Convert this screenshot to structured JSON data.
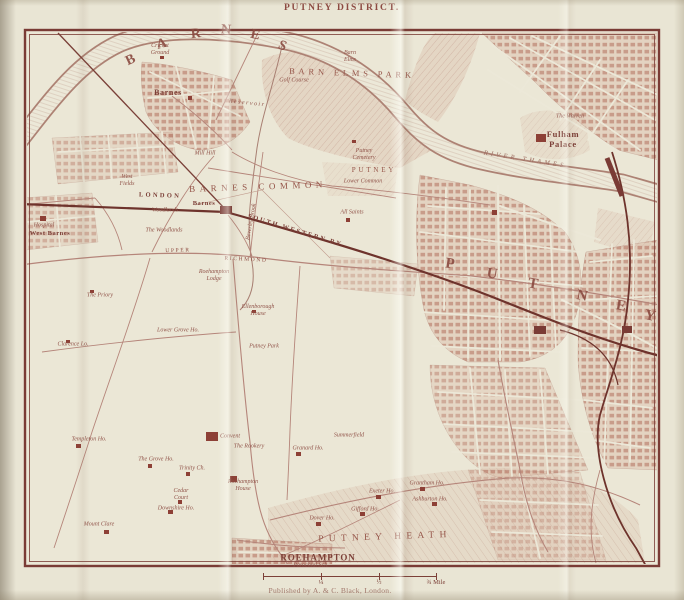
{
  "page": {
    "title": "PUTNEY DISTRICT.",
    "publisher": "Published by A. & C. Black, London."
  },
  "scale_bar": {
    "labels": [
      "¼",
      "½",
      "¾ Mile"
    ]
  },
  "colors": {
    "paper": "#e9e5d4",
    "ink": "#8d4a40",
    "frame": "#7a3b35",
    "urban": "#c89384",
    "railway": "#6e332c",
    "water_bank": "#ad8274"
  },
  "map": {
    "labels": [
      {
        "name": "label-barnes-letter",
        "text": "B",
        "x": 131,
        "y": 61,
        "fs": 14,
        "rot": -25,
        "cls": "bigletter"
      },
      {
        "name": "label-barnes-letter",
        "text": "A",
        "x": 162,
        "y": 45,
        "fs": 14,
        "rot": -15,
        "cls": "bigletter"
      },
      {
        "name": "label-barnes-letter",
        "text": "R",
        "x": 196,
        "y": 35,
        "fs": 14,
        "rot": -6,
        "cls": "bigletter"
      },
      {
        "name": "label-barnes-letter",
        "text": "N",
        "x": 226,
        "y": 31,
        "fs": 14,
        "rot": 4,
        "cls": "bigletter"
      },
      {
        "name": "label-barnes-letter",
        "text": "E",
        "x": 255,
        "y": 36,
        "fs": 14,
        "rot": 12,
        "cls": "bigletter"
      },
      {
        "name": "label-barnes-letter",
        "text": "S",
        "x": 282,
        "y": 47,
        "fs": 14,
        "rot": 22,
        "cls": "bigletter"
      },
      {
        "name": "label-putney-letter",
        "text": "P",
        "x": 450,
        "y": 264,
        "fs": 15,
        "rot": 8,
        "cls": "bigletter"
      },
      {
        "name": "label-putney-letter",
        "text": "U",
        "x": 492,
        "y": 274,
        "fs": 15,
        "rot": 8,
        "cls": "bigletter"
      },
      {
        "name": "label-putney-letter",
        "text": "T",
        "x": 533,
        "y": 284,
        "fs": 15,
        "rot": 10,
        "cls": "bigletter"
      },
      {
        "name": "label-putney-letter",
        "text": "N",
        "x": 582,
        "y": 296,
        "fs": 15,
        "rot": 10,
        "cls": "bigletter"
      },
      {
        "name": "label-putney-letter",
        "text": "E",
        "x": 621,
        "y": 306,
        "fs": 15,
        "rot": 10,
        "cls": "bigletter"
      },
      {
        "name": "label-putney-letter",
        "text": "Y",
        "x": 650,
        "y": 316,
        "fs": 15,
        "rot": 12,
        "cls": "bigletter"
      },
      {
        "name": "label-barn-elms-park",
        "text": "BARN ELMS PARK",
        "x": 352,
        "y": 73,
        "fs": 8.5,
        "ls": 0.45,
        "rot": 2,
        "cls": "district"
      },
      {
        "name": "label-barnes-common",
        "text": "BARNES COMMON",
        "x": 258,
        "y": 187,
        "fs": 9,
        "ls": 0.5,
        "rot": -2,
        "cls": "district"
      },
      {
        "name": "label-putney-heath",
        "text": "PUTNEY HEATH",
        "x": 385,
        "y": 538,
        "fs": 9.5,
        "ls": 0.55,
        "rot": -2,
        "cls": "district"
      },
      {
        "name": "label-roehampton",
        "text": "ROEHAMPTON",
        "x": 318,
        "y": 558,
        "fs": 9,
        "ls": 0.1,
        "cls": "town"
      },
      {
        "name": "label-putney-town",
        "text": "PUTNEY",
        "x": 374,
        "y": 170,
        "fs": 7,
        "ls": 0.4,
        "cls": "district"
      },
      {
        "name": "label-railway-london",
        "text": "LONDON",
        "x": 160,
        "y": 196,
        "fs": 6.5,
        "ls": 0.35,
        "rot": 2,
        "cls": "rail"
      },
      {
        "name": "label-railway-south-western",
        "text": "SOUTH WESTERN RY",
        "x": 295,
        "y": 231,
        "fs": 6.5,
        "ls": 0.3,
        "rot": 17,
        "cls": "rail"
      },
      {
        "name": "label-road-upper",
        "text": "UPPER",
        "x": 178,
        "y": 251,
        "fs": 5.5,
        "ls": 0.3,
        "rot": -2,
        "cls": "road"
      },
      {
        "name": "label-road-richmond",
        "text": "RICHMOND",
        "x": 246,
        "y": 260,
        "fs": 5.5,
        "ls": 0.3,
        "rot": 3,
        "cls": "road"
      },
      {
        "name": "label-river-thames",
        "text": "RIVER THAMES",
        "x": 525,
        "y": 160,
        "fs": 6.5,
        "ls": 0.5,
        "rot": 9,
        "cls": "water"
      },
      {
        "name": "label-town-barnes",
        "text": "Barnes",
        "x": 168,
        "y": 93,
        "fs": 8,
        "cls": "town"
      },
      {
        "name": "label-station-barnes",
        "text": "Barnes",
        "x": 204,
        "y": 204,
        "fs": 6.5,
        "cls": "town"
      },
      {
        "name": "label-town-west-barnes",
        "text": "West Barnes",
        "x": 50,
        "y": 234,
        "fs": 6.5,
        "cls": "town"
      },
      {
        "name": "label-fulham-palace",
        "text": "Fulham\nPalace",
        "x": 563,
        "y": 139,
        "fs": 8.5,
        "cls": "town"
      },
      {
        "name": "label-cricket-ground",
        "text": "Cricket\nGround",
        "x": 160,
        "y": 50,
        "cls": "italic"
      },
      {
        "name": "label-reservoir",
        "text": "Reservoir",
        "x": 247,
        "y": 104,
        "ls": 0.25,
        "rot": 6,
        "cls": "italic"
      },
      {
        "name": "label-beverley-brook",
        "text": "Beverley Brook",
        "x": 252,
        "y": 222,
        "rot": -80,
        "cls": "italic"
      },
      {
        "name": "label-mill-hill",
        "text": "Mill Hill",
        "x": 205,
        "y": 154,
        "cls": "italic"
      },
      {
        "name": "label-west-fields",
        "text": "West\nFields",
        "x": 127,
        "y": 181,
        "cls": "italic"
      },
      {
        "name": "label-hospital",
        "text": "Hospital",
        "x": 44,
        "y": 226,
        "cls": "italic"
      },
      {
        "name": "label-woodlands",
        "text": "Woodlands",
        "x": 165,
        "y": 211,
        "cls": "italic"
      },
      {
        "name": "label-the-woodlands",
        "text": "The Woodlands",
        "x": 164,
        "y": 231,
        "cls": "italic"
      },
      {
        "name": "label-barn-elms",
        "text": "Barn\nElms",
        "x": 350,
        "y": 57,
        "cls": "italic"
      },
      {
        "name": "label-golf-course",
        "text": "Golf Course",
        "x": 294,
        "y": 81,
        "cls": "italic"
      },
      {
        "name": "label-putney-cemetery",
        "text": "Putney\nCemetery",
        "x": 364,
        "y": 155,
        "cls": "italic"
      },
      {
        "name": "label-lower-common",
        "text": "Lower Common",
        "x": 363,
        "y": 182,
        "cls": "italic"
      },
      {
        "name": "label-all-saints",
        "text": "All Saints",
        "x": 352,
        "y": 213,
        "cls": "italic"
      },
      {
        "name": "label-the-warren",
        "text": "The Warren",
        "x": 570,
        "y": 117,
        "cls": "italic"
      },
      {
        "name": "label-the-priory",
        "text": "The Priory",
        "x": 100,
        "y": 296,
        "cls": "italic"
      },
      {
        "name": "label-roehampton-lodge",
        "text": "Roehampton\nLodge",
        "x": 214,
        "y": 276,
        "cls": "italic"
      },
      {
        "name": "label-ellenborough-house",
        "text": "Ellenborough\nHouse",
        "x": 258,
        "y": 311,
        "cls": "italic"
      },
      {
        "name": "label-lower-grove-ho",
        "text": "Lower Grove Ho.",
        "x": 178,
        "y": 331,
        "cls": "italic"
      },
      {
        "name": "label-putney-park",
        "text": "Putney Park",
        "x": 264,
        "y": 347,
        "cls": "italic"
      },
      {
        "name": "label-clarence-lo",
        "text": "Clarence Lo.",
        "x": 73,
        "y": 345,
        "cls": "italic"
      },
      {
        "name": "label-templeton-ho",
        "text": "Templeton Ho.",
        "x": 89,
        "y": 440,
        "cls": "italic"
      },
      {
        "name": "label-the-grove-ho",
        "text": "The Grove Ho.",
        "x": 156,
        "y": 460,
        "cls": "italic"
      },
      {
        "name": "label-trinity-ch",
        "text": "Trinity Ch.",
        "x": 192,
        "y": 469,
        "cls": "italic"
      },
      {
        "name": "label-convent",
        "text": "Convent",
        "x": 230,
        "y": 437,
        "cls": "italic"
      },
      {
        "name": "label-the-rookery",
        "text": "The Rookery",
        "x": 249,
        "y": 447,
        "cls": "italic"
      },
      {
        "name": "label-roehampton-house",
        "text": "Roehampton\nHouse",
        "x": 243,
        "y": 486,
        "cls": "italic"
      },
      {
        "name": "label-cedar-court",
        "text": "Cedar\nCourt",
        "x": 181,
        "y": 495,
        "cls": "italic"
      },
      {
        "name": "label-downshire-ho",
        "text": "Downshire Ho.",
        "x": 176,
        "y": 509,
        "cls": "italic"
      },
      {
        "name": "label-mount-clare",
        "text": "Mount Clare",
        "x": 99,
        "y": 525,
        "cls": "italic"
      },
      {
        "name": "label-summerfield",
        "text": "Summerfield",
        "x": 349,
        "y": 436,
        "cls": "italic"
      },
      {
        "name": "label-granard-ho",
        "text": "Granard Ho.",
        "x": 308,
        "y": 449,
        "cls": "italic"
      },
      {
        "name": "label-exeter-ho",
        "text": "Exeter Ho.",
        "x": 382,
        "y": 492,
        "cls": "italic"
      },
      {
        "name": "label-grantham-ho",
        "text": "Grantham Ho.",
        "x": 427,
        "y": 484,
        "cls": "italic"
      },
      {
        "name": "label-ashburton-ho",
        "text": "Ashburton Ho.",
        "x": 430,
        "y": 500,
        "cls": "italic"
      },
      {
        "name": "label-gifford-ho",
        "text": "Gifford Ho.",
        "x": 365,
        "y": 510,
        "cls": "italic"
      },
      {
        "name": "label-dover-ho",
        "text": "Dover Ho.",
        "x": 322,
        "y": 519,
        "cls": "italic"
      },
      {
        "name": "label-parochial-sch",
        "text": "Parochial Sch.",
        "x": 311,
        "y": 566,
        "cls": "italic"
      }
    ]
  }
}
